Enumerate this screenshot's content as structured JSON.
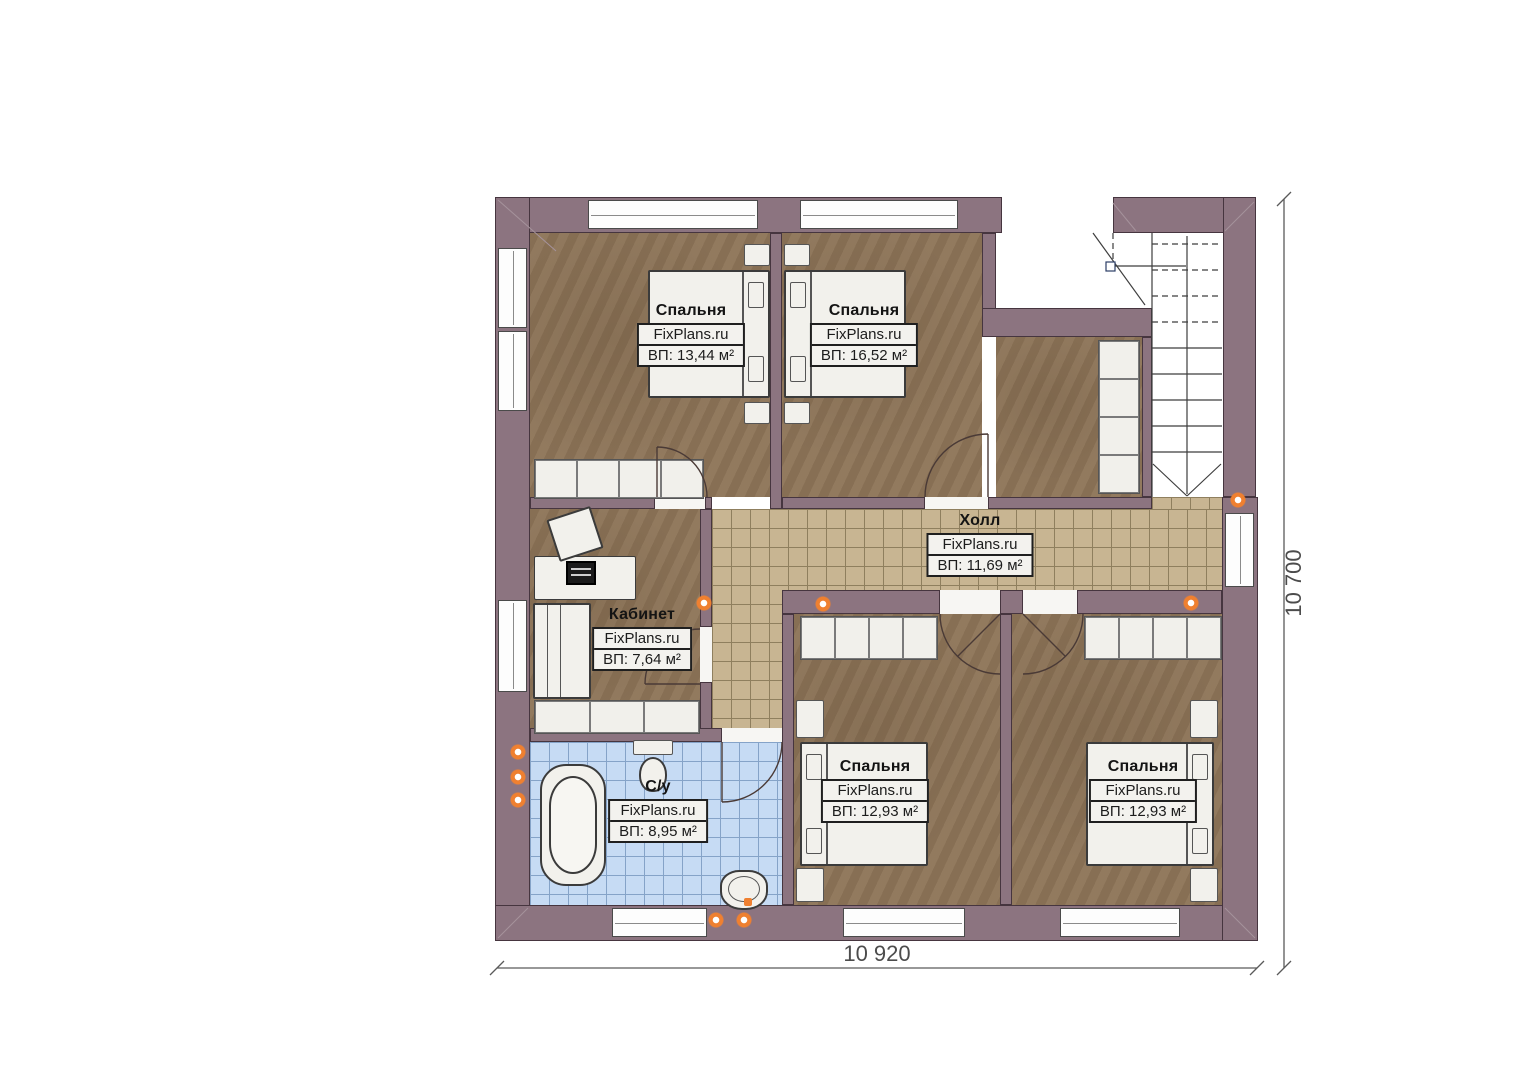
{
  "plan": {
    "rooms": [
      {
        "id": "bedroom-top-left",
        "name": "Спальня",
        "brand": "FixPlans.ru",
        "area": "ВП: 13,44 м²"
      },
      {
        "id": "bedroom-top-right",
        "name": "Спальня",
        "brand": "FixPlans.ru",
        "area": "ВП: 16,52 м²"
      },
      {
        "id": "hall",
        "name": "Холл",
        "brand": "FixPlans.ru",
        "area": "ВП: 11,69 м²"
      },
      {
        "id": "office",
        "name": "Кабинет",
        "brand": "FixPlans.ru",
        "area": "ВП: 7,64 м²"
      },
      {
        "id": "bathroom",
        "name": "С/у",
        "brand": "FixPlans.ru",
        "area": "ВП: 8,95 м²"
      },
      {
        "id": "bedroom-bottom-left",
        "name": "Спальня",
        "brand": "FixPlans.ru",
        "area": "ВП: 12,93 м²"
      },
      {
        "id": "bedroom-bottom-right",
        "name": "Спальня",
        "brand": "FixPlans.ru",
        "area": "ВП: 12,93 м²"
      }
    ],
    "dimensions": {
      "width": "10 920",
      "height": "10 700"
    },
    "colors": {
      "wall": "#8c7480",
      "bedroom_floor": "#8e7558",
      "hall_tile": "#c8b592",
      "bath_tile": "#c6dbf4",
      "accent_dot": "#ef8030"
    }
  }
}
